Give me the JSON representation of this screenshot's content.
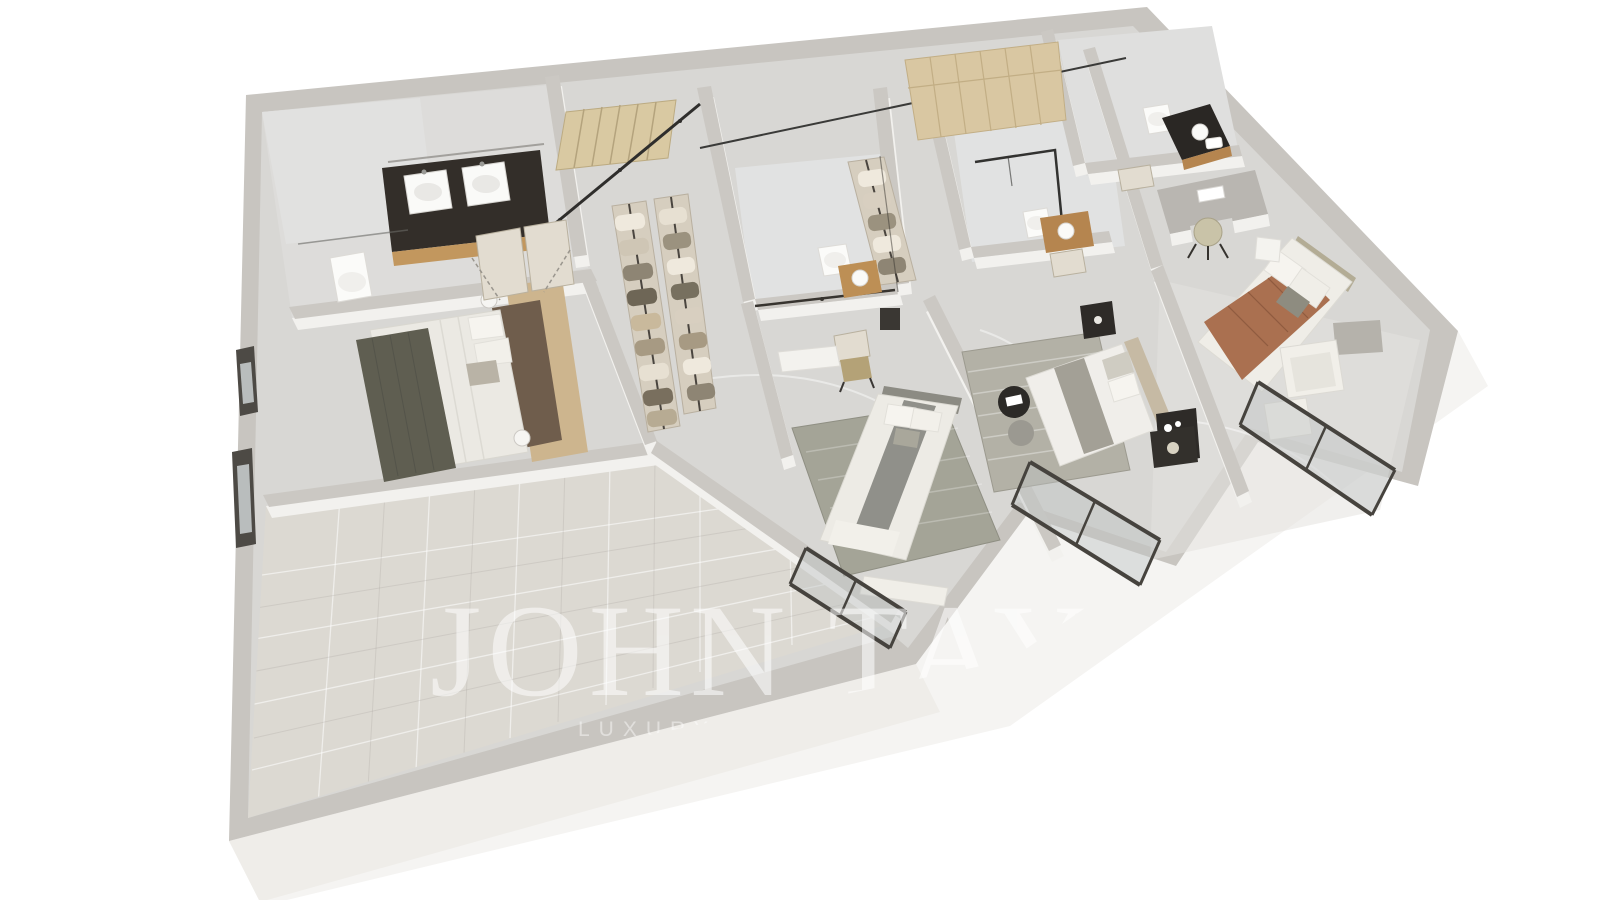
{
  "watermark": {
    "brand": "JOHN TAY",
    "tagline": "LUXURY R",
    "color": "#ffffff",
    "brand_opacity": 0.55,
    "tagline_opacity": 0.45
  },
  "scene": {
    "type": "3d-floor-plan-render",
    "view": "axonometric top-down",
    "description": "3D rendered upper-floor plan of a luxury residence with four bedrooms, four bathrooms, a walk-in dressing room, a staircase and a large empty room; white walls, grey marble floors, wood cabinetry.",
    "elements": [
      "exterior-wall",
      "bathroom-double-vanity",
      "wall-hung-toilet",
      "master-bedroom-bed",
      "walk-in-closet-racks",
      "staircase",
      "shower-room",
      "wood-wardrobe",
      "desk-with-chair",
      "bedroom-bed-grey-runner",
      "bedroom-bed-striped-rug",
      "bedroom-bed-brown-blanket",
      "armchair-with-ottoman",
      "window-bay-glass",
      "empty-room"
    ],
    "palette": {
      "background": "#ffffff",
      "wall_top": "#c8c5c0",
      "wall_face": "#f2f1ee",
      "floor_marble": "#d8d7d4",
      "floor_light_room": "#dcd9d2",
      "shower_marble": "#e1e2e2",
      "wood_vanity": "#c2975e",
      "wood_wardrobe": "#d9c7a2",
      "wood_stairs": "#d9c9a2",
      "bed_throw_dark": "#5f5e51",
      "bed_blanket_brown": "#aa7050",
      "rug_sage": "#a4a497",
      "rug_striped": "#b3b1a6",
      "window_frame": "#46433e",
      "counter_dark": "#332e29",
      "nightstand_black": "#2e2b28"
    }
  }
}
